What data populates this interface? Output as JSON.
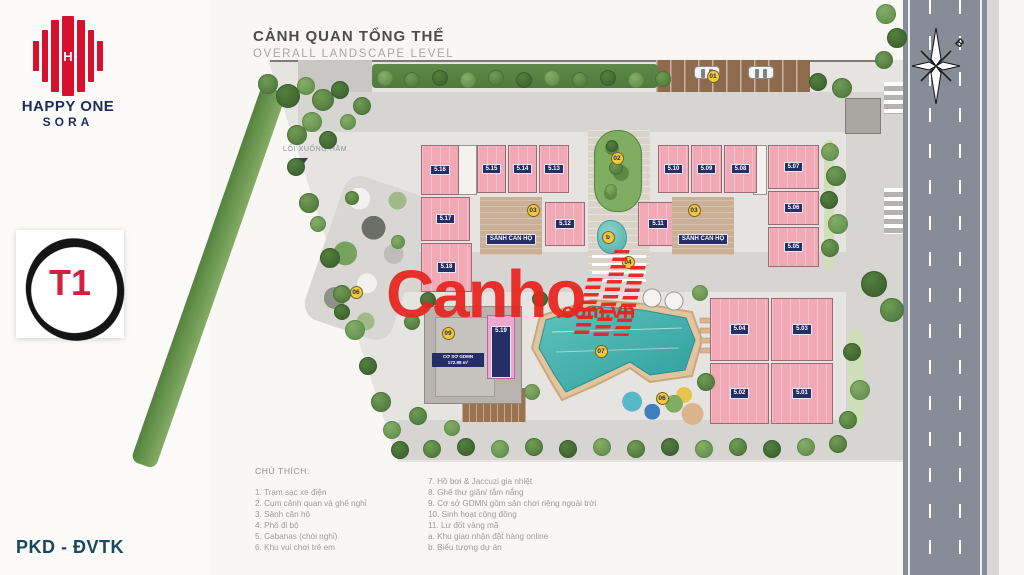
{
  "colors": {
    "brand_red": "#d6112e",
    "brand_navy": "#1c2c5c",
    "watermark_red": "#e8251f",
    "building_pink": "#f0a9b5",
    "unit_chip_navy": "#252f66",
    "pool_teal": "#49aca6",
    "badge_yellow": "#f3c83e",
    "footer_navy": "#16495f"
  },
  "branding": {
    "name_line1": "HAPPY ONE",
    "name_line2": "SORA"
  },
  "tower_badge": {
    "label": "T1"
  },
  "footer": {
    "label": "PKD - ĐVTK"
  },
  "title": {
    "main": "CẢNH QUAN TỔNG THỂ",
    "sub": "OVERALL LANDSCAPE LEVEL"
  },
  "watermark": {
    "text": "Canho",
    "suffix": ".com.vn"
  },
  "plan": {
    "ramp_label": "LỐI XUỐNG HẦM",
    "north_label": "B",
    "lobby_label": "SẢNH CĂN HỘ",
    "kindergarten": {
      "unit": "5.19",
      "label1": "CƠ SỞ GDMN",
      "label2": "172.98 m²"
    },
    "buildings": [
      {
        "label": "5.16",
        "x": 421,
        "y": 145,
        "w": 38,
        "h": 50
      },
      {
        "label": "5.15",
        "x": 477,
        "y": 145,
        "w": 29,
        "h": 48
      },
      {
        "label": "5.14",
        "x": 508,
        "y": 145,
        "w": 29,
        "h": 48
      },
      {
        "label": "5.13",
        "x": 539,
        "y": 145,
        "w": 30,
        "h": 48
      },
      {
        "label": "5.17",
        "x": 421,
        "y": 197,
        "w": 49,
        "h": 44
      },
      {
        "label": "5.18",
        "x": 421,
        "y": 243,
        "w": 51,
        "h": 49
      },
      {
        "label": "5.12",
        "x": 545,
        "y": 202,
        "w": 40,
        "h": 44
      },
      {
        "label": "5.10",
        "x": 658,
        "y": 145,
        "w": 31,
        "h": 48
      },
      {
        "label": "5.09",
        "x": 691,
        "y": 145,
        "w": 31,
        "h": 48
      },
      {
        "label": "5.08",
        "x": 724,
        "y": 145,
        "w": 33,
        "h": 48
      },
      {
        "label": "5.07",
        "x": 768,
        "y": 145,
        "w": 51,
        "h": 44
      },
      {
        "label": "5.06",
        "x": 768,
        "y": 191,
        "w": 51,
        "h": 34
      },
      {
        "label": "5.05",
        "x": 768,
        "y": 227,
        "w": 51,
        "h": 40
      },
      {
        "label": "5.11",
        "x": 638,
        "y": 202,
        "w": 40,
        "h": 44
      },
      {
        "label": "5.04",
        "x": 710,
        "y": 298,
        "w": 59,
        "h": 63
      },
      {
        "label": "5.03",
        "x": 771,
        "y": 298,
        "w": 62,
        "h": 63
      },
      {
        "label": "5.02",
        "x": 710,
        "y": 363,
        "w": 59,
        "h": 61
      },
      {
        "label": "5.01",
        "x": 771,
        "y": 363,
        "w": 62,
        "h": 61
      }
    ],
    "lobbies": [
      {
        "x": 480,
        "y": 197,
        "w": 62,
        "h": 58
      },
      {
        "x": 672,
        "y": 197,
        "w": 62,
        "h": 58
      }
    ],
    "cores": [
      [
        457,
        145,
        20,
        50
      ],
      [
        753,
        145,
        14,
        50
      ]
    ],
    "badges": [
      {
        "n": "01",
        "x": 713,
        "y": 76
      },
      {
        "n": "02",
        "x": 617,
        "y": 158
      },
      {
        "n": "03",
        "x": 533,
        "y": 210
      },
      {
        "n": "03",
        "x": 694,
        "y": 210
      },
      {
        "n": "04",
        "x": 628,
        "y": 262
      },
      {
        "n": "b",
        "x": 608,
        "y": 237
      },
      {
        "n": "06",
        "x": 356,
        "y": 292
      },
      {
        "n": "06",
        "x": 662,
        "y": 398
      },
      {
        "n": "07",
        "x": 601,
        "y": 351
      },
      {
        "n": "09",
        "x": 448,
        "y": 333
      }
    ],
    "cars": [
      {
        "x": 694,
        "y": 66
      },
      {
        "x": 748,
        "y": 66
      }
    ],
    "trees": [
      [
        268,
        84,
        10,
        0
      ],
      [
        288,
        96,
        12,
        1
      ],
      [
        306,
        86,
        9,
        2
      ],
      [
        323,
        100,
        11,
        0
      ],
      [
        340,
        90,
        9,
        1
      ],
      [
        312,
        122,
        10,
        2
      ],
      [
        297,
        135,
        10,
        0
      ],
      [
        328,
        140,
        9,
        1
      ],
      [
        348,
        122,
        8,
        2
      ],
      [
        362,
        106,
        9,
        0
      ],
      [
        296,
        167,
        9,
        1
      ],
      [
        309,
        203,
        10,
        0
      ],
      [
        318,
        224,
        8,
        2
      ],
      [
        330,
        258,
        10,
        1
      ],
      [
        342,
        294,
        9,
        0
      ],
      [
        355,
        330,
        10,
        2
      ],
      [
        368,
        366,
        9,
        1
      ],
      [
        381,
        402,
        10,
        0
      ],
      [
        392,
        430,
        9,
        2
      ],
      [
        400,
        450,
        9,
        1
      ],
      [
        385,
        78,
        8,
        2
      ],
      [
        412,
        80,
        8,
        0
      ],
      [
        440,
        78,
        8,
        1
      ],
      [
        468,
        80,
        8,
        2
      ],
      [
        496,
        78,
        8,
        0
      ],
      [
        524,
        80,
        8,
        1
      ],
      [
        552,
        78,
        8,
        2
      ],
      [
        580,
        80,
        8,
        0
      ],
      [
        608,
        78,
        8,
        1
      ],
      [
        636,
        80,
        8,
        2
      ],
      [
        663,
        79,
        8,
        0
      ],
      [
        818,
        82,
        9,
        1
      ],
      [
        842,
        88,
        10,
        0
      ],
      [
        830,
        152,
        9,
        2
      ],
      [
        836,
        176,
        10,
        0
      ],
      [
        829,
        200,
        9,
        1
      ],
      [
        838,
        224,
        10,
        2
      ],
      [
        830,
        248,
        9,
        0
      ],
      [
        874,
        284,
        13,
        1
      ],
      [
        892,
        310,
        12,
        0
      ],
      [
        886,
        14,
        10,
        2
      ],
      [
        897,
        38,
        10,
        1
      ],
      [
        884,
        60,
        9,
        0
      ],
      [
        432,
        449,
        9,
        0
      ],
      [
        466,
        447,
        9,
        1
      ],
      [
        500,
        449,
        9,
        2
      ],
      [
        534,
        447,
        9,
        0
      ],
      [
        568,
        449,
        9,
        1
      ],
      [
        602,
        447,
        9,
        2
      ],
      [
        636,
        449,
        9,
        0
      ],
      [
        670,
        447,
        9,
        1
      ],
      [
        704,
        449,
        9,
        2
      ],
      [
        738,
        447,
        9,
        0
      ],
      [
        772,
        449,
        9,
        1
      ],
      [
        806,
        447,
        9,
        2
      ],
      [
        838,
        444,
        9,
        0
      ],
      [
        540,
        299,
        8,
        1
      ],
      [
        700,
        293,
        8,
        2
      ],
      [
        706,
        382,
        9,
        0
      ],
      [
        532,
        392,
        8,
        2
      ],
      [
        428,
        300,
        8,
        1
      ],
      [
        418,
        416,
        9,
        0
      ],
      [
        452,
        428,
        8,
        2
      ],
      [
        612,
        146,
        6,
        1
      ],
      [
        616,
        168,
        7,
        0
      ],
      [
        611,
        190,
        6,
        2
      ],
      [
        352,
        198,
        7,
        0
      ],
      [
        398,
        242,
        7,
        2
      ],
      [
        342,
        312,
        8,
        1
      ],
      [
        412,
        322,
        8,
        0
      ],
      [
        852,
        352,
        9,
        1
      ],
      [
        860,
        390,
        10,
        2
      ],
      [
        848,
        420,
        9,
        0
      ]
    ]
  },
  "legend": {
    "title": "CHÚ THÍCH:",
    "col1": [
      "1. Trạm sạc xe điện",
      "2. Cụm cảnh quan và ghế nghỉ",
      "3. Sảnh căn hộ",
      "4. Phố đi bộ",
      "5. Cabanas (chòi nghỉ)",
      "6. Khu vui chơi trẻ em"
    ],
    "col2": [
      "7. Hồ bơi & Jaccuzi gia nhiệt",
      "8. Ghế thư giãn/ tắm nắng",
      "9. Cơ sở GDMN gồm sân chơi riêng ngoài trời",
      "10. Sinh hoạt cộng đồng",
      "11. Lư đốt vàng mã",
      "a. Khu giao nhận đặt hàng online",
      "b. Biểu tượng dự án"
    ]
  }
}
